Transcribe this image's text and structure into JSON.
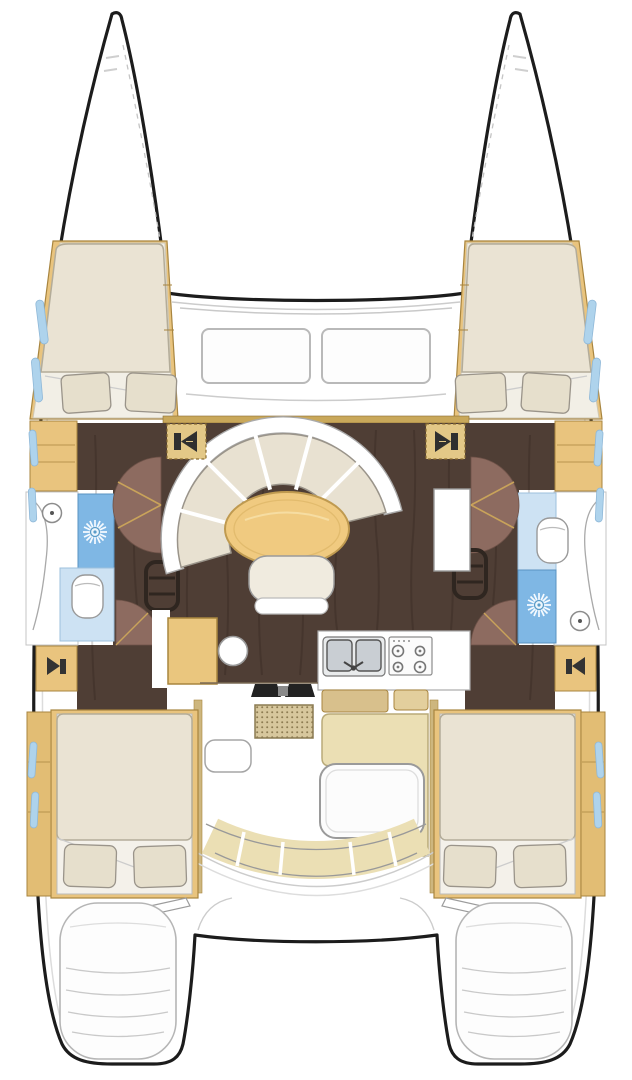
{
  "title": "Catamaran interior layout floor plan, top-down view",
  "vessel": {
    "type": "sailing catamaran",
    "view": "overhead deck and accommodation plan",
    "hulls": 2,
    "cabins": 4,
    "heads": 2
  },
  "colors": {
    "outline": "#1c1c1c",
    "wood_tan": "#e9c47e",
    "wood_tan_dark": "#a8853f",
    "table_wood": "#f0ca80",
    "cushion_beige": "#e8e1d1",
    "mattress": "#eae3d3",
    "floor_dark_brown": "#4f3e35",
    "door_swing_mauve": "#8d6b60",
    "shower_blue": "#7fb7e4",
    "toilet_room_blue": "#cde2f3",
    "window_blue": "#aed3ec",
    "cockpit_seat_khaki": "#ebdfb4",
    "galley_steel": "#c9ced3",
    "detail_gray": "#999999"
  },
  "regions": {
    "bow_port": "port bow with trampoline edge",
    "bow_starboard": "starboard bow with trampoline edge",
    "trampoline": "open foredeck trampoline between bows",
    "foredeck": "coachroof front with two windows",
    "forward_cabin_port": "double V-berth, two pillows, side shelves",
    "forward_cabin_starboard": "double V-berth, two pillows, side shelves",
    "head_port": "shower with drain, toilet, washbasin",
    "head_starboard": "toilet, shower with drain, washbasin",
    "salon": "curved settee with six cushions, oval dining table, bench seat, chart table with stool, two speakers",
    "galley": "double sink, four-burner stove, counters, cabinet",
    "companionways": "step units down into each hull, door swing arcs",
    "cockpit": "entry mat, side table, L-shaped bench, cockpit table, curved aft bench",
    "aft_cabin_port": "double berth, two pillows, wardrobe with hull windows",
    "aft_cabin_starboard": "double berth, two pillows, wardrobe with hull windows",
    "aft_deck": "open platform between sterns with boarding steps",
    "stern_platform_port": "transom swim steps",
    "stern_platform_starboard": "transom swim steps"
  },
  "icons": {
    "speaker": 4,
    "shower_drain_sun": 2,
    "washbasin_round": 2,
    "toilet": 2,
    "stove_burners": 4,
    "sink_basins": 2,
    "step_ladder": 2,
    "door_swing_arc": 4
  }
}
